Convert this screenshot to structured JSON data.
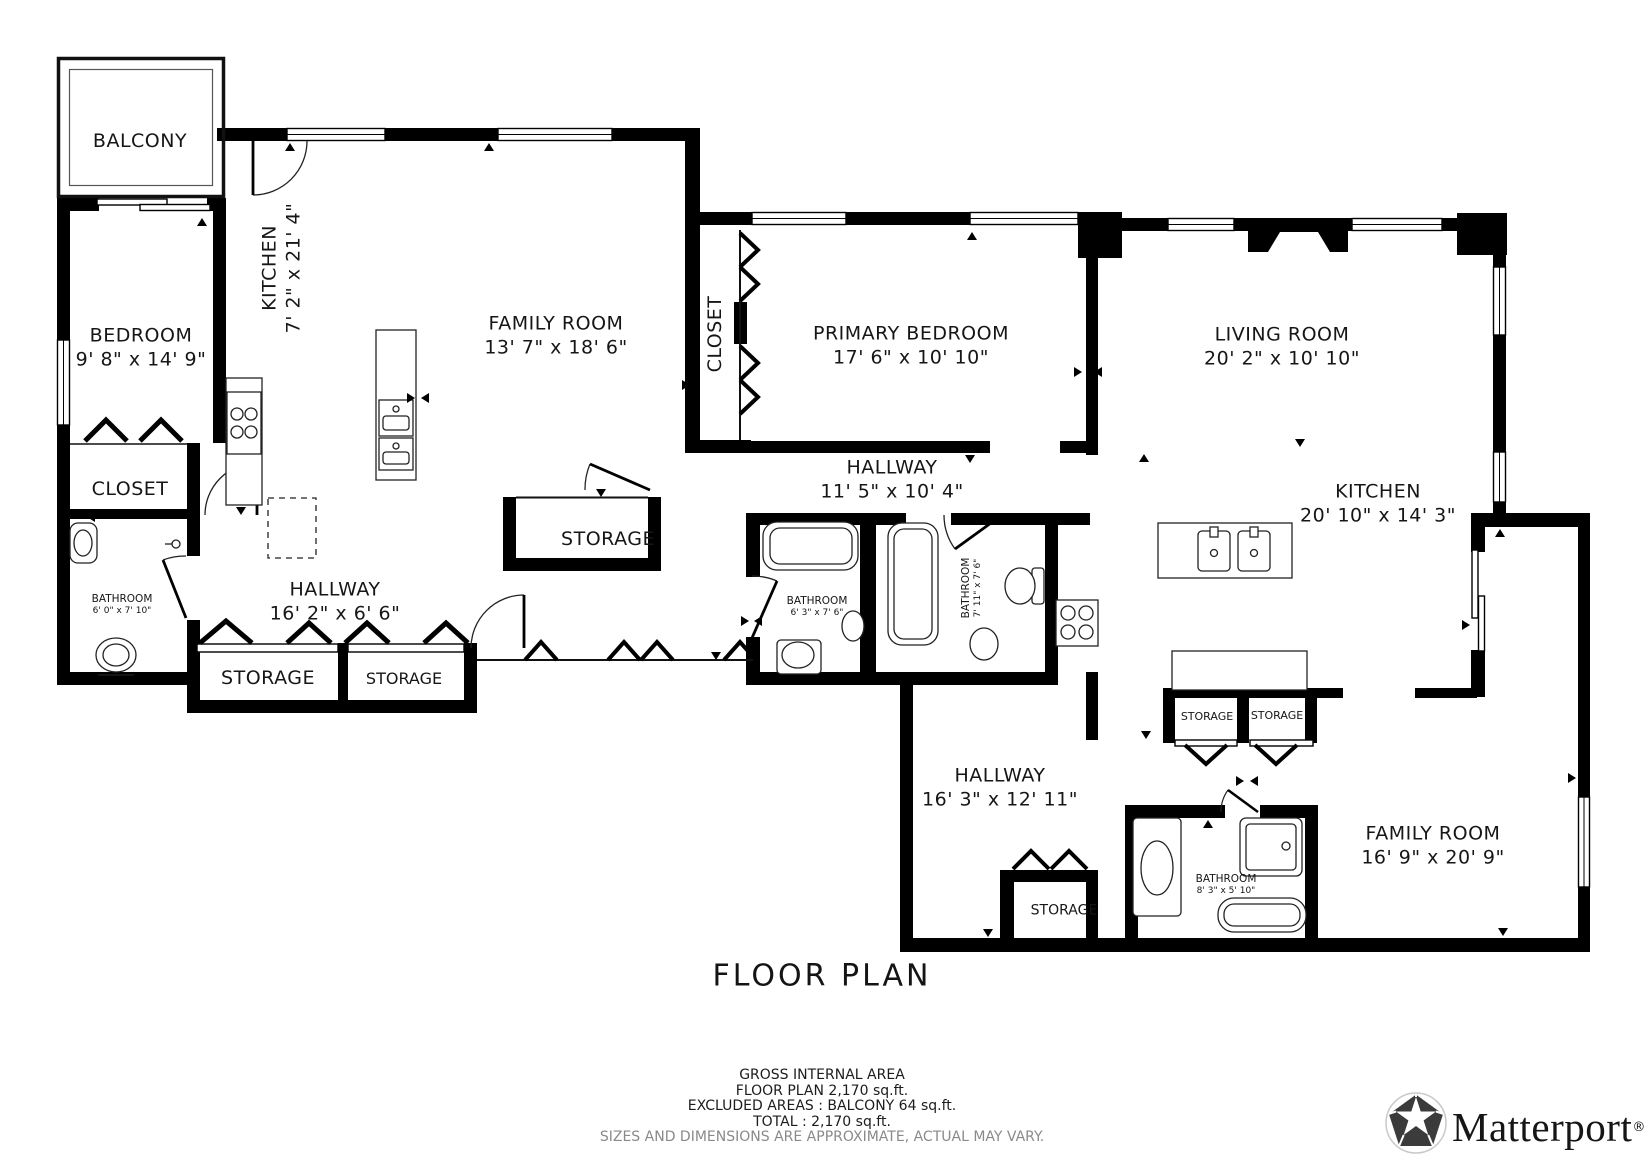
{
  "rooms": [
    {
      "name": "BALCONY",
      "dims": ""
    },
    {
      "name": "BEDROOM",
      "dims": "9' 8\" x 14' 9\""
    },
    {
      "name": "KITCHEN",
      "dims": "7' 2\" x 21' 4\""
    },
    {
      "name": "FAMILY ROOM",
      "dims": "13' 7\" x 18' 6\""
    },
    {
      "name": "CLOSET",
      "dims": ""
    },
    {
      "name": "PRIMARY BEDROOM",
      "dims": "17' 6\" x 10' 10\""
    },
    {
      "name": "LIVING ROOM",
      "dims": "20' 2\" x 10' 10\""
    },
    {
      "name": "HALLWAY",
      "dims": "11' 5\" x 10' 4\""
    },
    {
      "name": "KITCHEN",
      "dims": "20' 10\" x 14' 3\""
    },
    {
      "name": "STORAGE",
      "dims": ""
    },
    {
      "name": "CLOSET",
      "dims": ""
    },
    {
      "name": "BATHROOM",
      "dims": "6' 0\" x 7' 10\""
    },
    {
      "name": "HALLWAY",
      "dims": "16' 2\" x 6' 6\""
    },
    {
      "name": "STORAGE",
      "dims": ""
    },
    {
      "name": "STORAGE",
      "dims": ""
    },
    {
      "name": "BATHROOM",
      "dims": "6' 3\" x 7' 6\""
    },
    {
      "name": "BATHROOM",
      "dims": "7' 11\" x 7' 6\""
    },
    {
      "name": "STORAGE",
      "dims": ""
    },
    {
      "name": "STORAGE",
      "dims": ""
    },
    {
      "name": "HALLWAY",
      "dims": "16' 3\" x 12' 11\""
    },
    {
      "name": "STORAGE",
      "dims": ""
    },
    {
      "name": "BATHROOM",
      "dims": "8' 3\" x 5' 10\""
    },
    {
      "name": "FAMILY ROOM",
      "dims": "16' 9\" x 20' 9\""
    }
  ],
  "title": "FLOOR PLAN",
  "footer": {
    "line1": "GROSS INTERNAL AREA",
    "line2": "FLOOR PLAN 2,170 sq.ft.",
    "line3": "EXCLUDED AREAS :   BALCONY 64 sq.ft.",
    "line4": "TOTAL :  2,170 sq.ft.",
    "disclaimer": "SIZES AND DIMENSIONS ARE APPROXIMATE, ACTUAL MAY VARY."
  },
  "branding": {
    "name": "Matterport",
    "registered": "®"
  },
  "colors": {
    "wall": "#000000",
    "text": "#161616",
    "muted": "#8a8a8a"
  }
}
